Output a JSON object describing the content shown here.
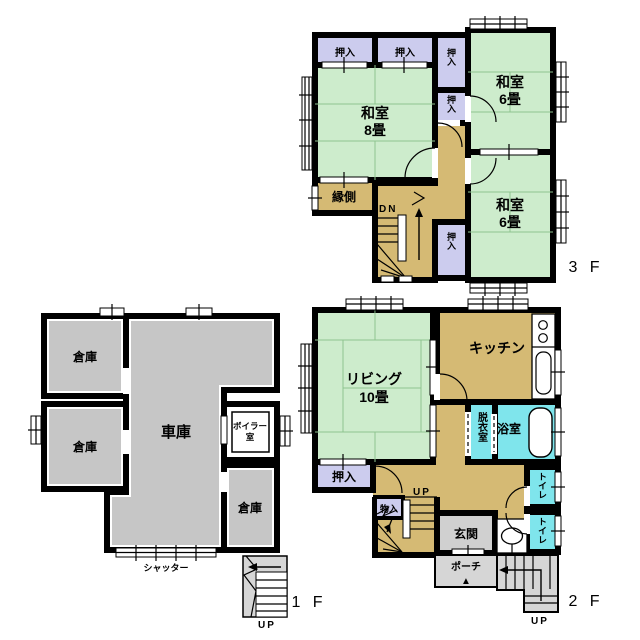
{
  "palette": {
    "wall": "#000000",
    "tatami_green": "#cdeccc",
    "tatami_line": "#8fc48f",
    "closet_lavender": "#ccccee",
    "corridor_tan": "#d5ba74",
    "water_cyan": "#7fe5ec",
    "garage_gray": "#c6c6c6",
    "exterior_gray": "#d6d6d6",
    "floor_white": "#ffffff"
  },
  "floor3": {
    "label": "3 F",
    "oshiire_a": "押入",
    "oshiire_b": "押入",
    "oshiire_c": "押入",
    "oshiire_d": "押入",
    "oshiire_e": "押入",
    "washitsu8_name": "和室",
    "washitsu8_size": "8畳",
    "washitsu6a_name": "和室",
    "washitsu6a_size": "6畳",
    "washitsu6b_name": "和室",
    "washitsu6b_size": "6畳",
    "engawa": "縁側",
    "stairs_down": "DN"
  },
  "floor2": {
    "label": "2 F",
    "living_name": "リビング",
    "living_size": "10畳",
    "kitchen": "キッチン",
    "dressing_room": "脱衣室",
    "bathroom": "浴室",
    "toilet_upper": "トイレ",
    "toilet_lower": "トイレ",
    "oshiire": "押入",
    "monoire": "物入",
    "entrance": "玄関",
    "porch": "ポーチ",
    "porch_marker": "▲",
    "stairs_up_inner": "UP",
    "stairs_up_outer": "UP"
  },
  "floor1": {
    "label": "1 F",
    "souko_a": "倉庫",
    "souko_b": "倉庫",
    "souko_c": "倉庫",
    "garage": "車庫",
    "boiler_line1": "ボイラー",
    "boiler_line2": "室",
    "shutter": "シャッター",
    "stairs_up": "UP"
  }
}
